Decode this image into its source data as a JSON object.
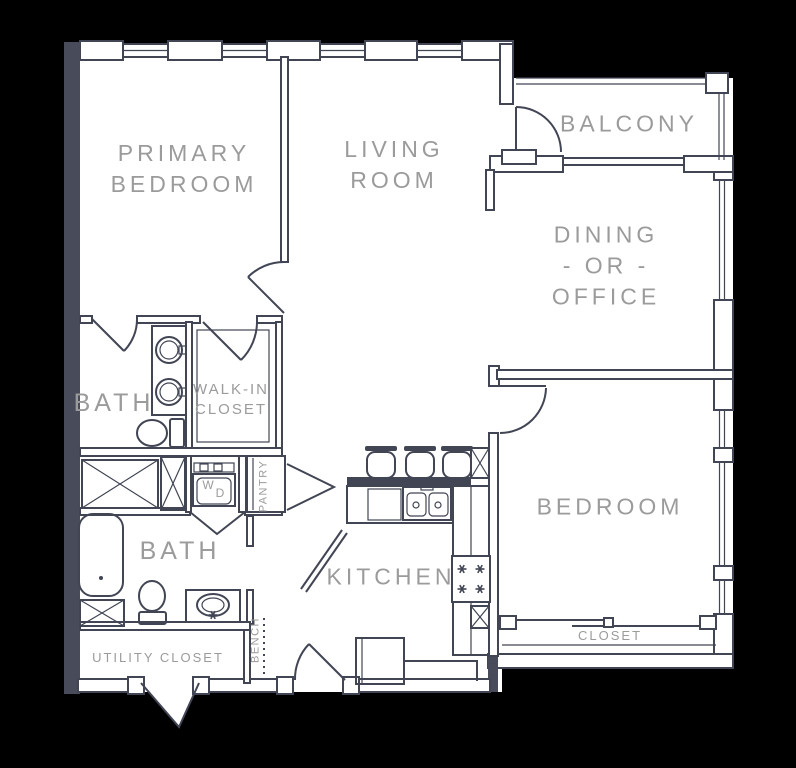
{
  "palette": {
    "background": "#000000",
    "wall_line": "#414554",
    "wall_fill": "#474b5a",
    "floor": "#ffffff",
    "label_text": "#9b9b9b"
  },
  "rooms": {
    "primary_bedroom": {
      "line1": "PRIMARY",
      "line2": "BEDROOM"
    },
    "living_room": {
      "line1": "LIVING",
      "line2": "ROOM"
    },
    "balcony": {
      "label": "BALCONY"
    },
    "dining_office": {
      "line1": "DINING",
      "line2": "- OR -",
      "line3": "OFFICE"
    },
    "bedroom": {
      "label": "BEDROOM"
    },
    "bedroom_closet": {
      "label": "CLOSET"
    },
    "bath_primary": {
      "label": "BATH"
    },
    "walk_in_closet": {
      "line1": "WALK-IN",
      "line2": "CLOSET"
    },
    "bath_second": {
      "label": "BATH"
    },
    "kitchen": {
      "label": "KITCHEN"
    },
    "utility_closet": {
      "label": "UTILITY CLOSET"
    },
    "pantry": {
      "label": "PANTRY"
    },
    "bench": {
      "label": "BENCH"
    }
  },
  "appliances": {
    "washer": "W",
    "dryer": "D"
  }
}
